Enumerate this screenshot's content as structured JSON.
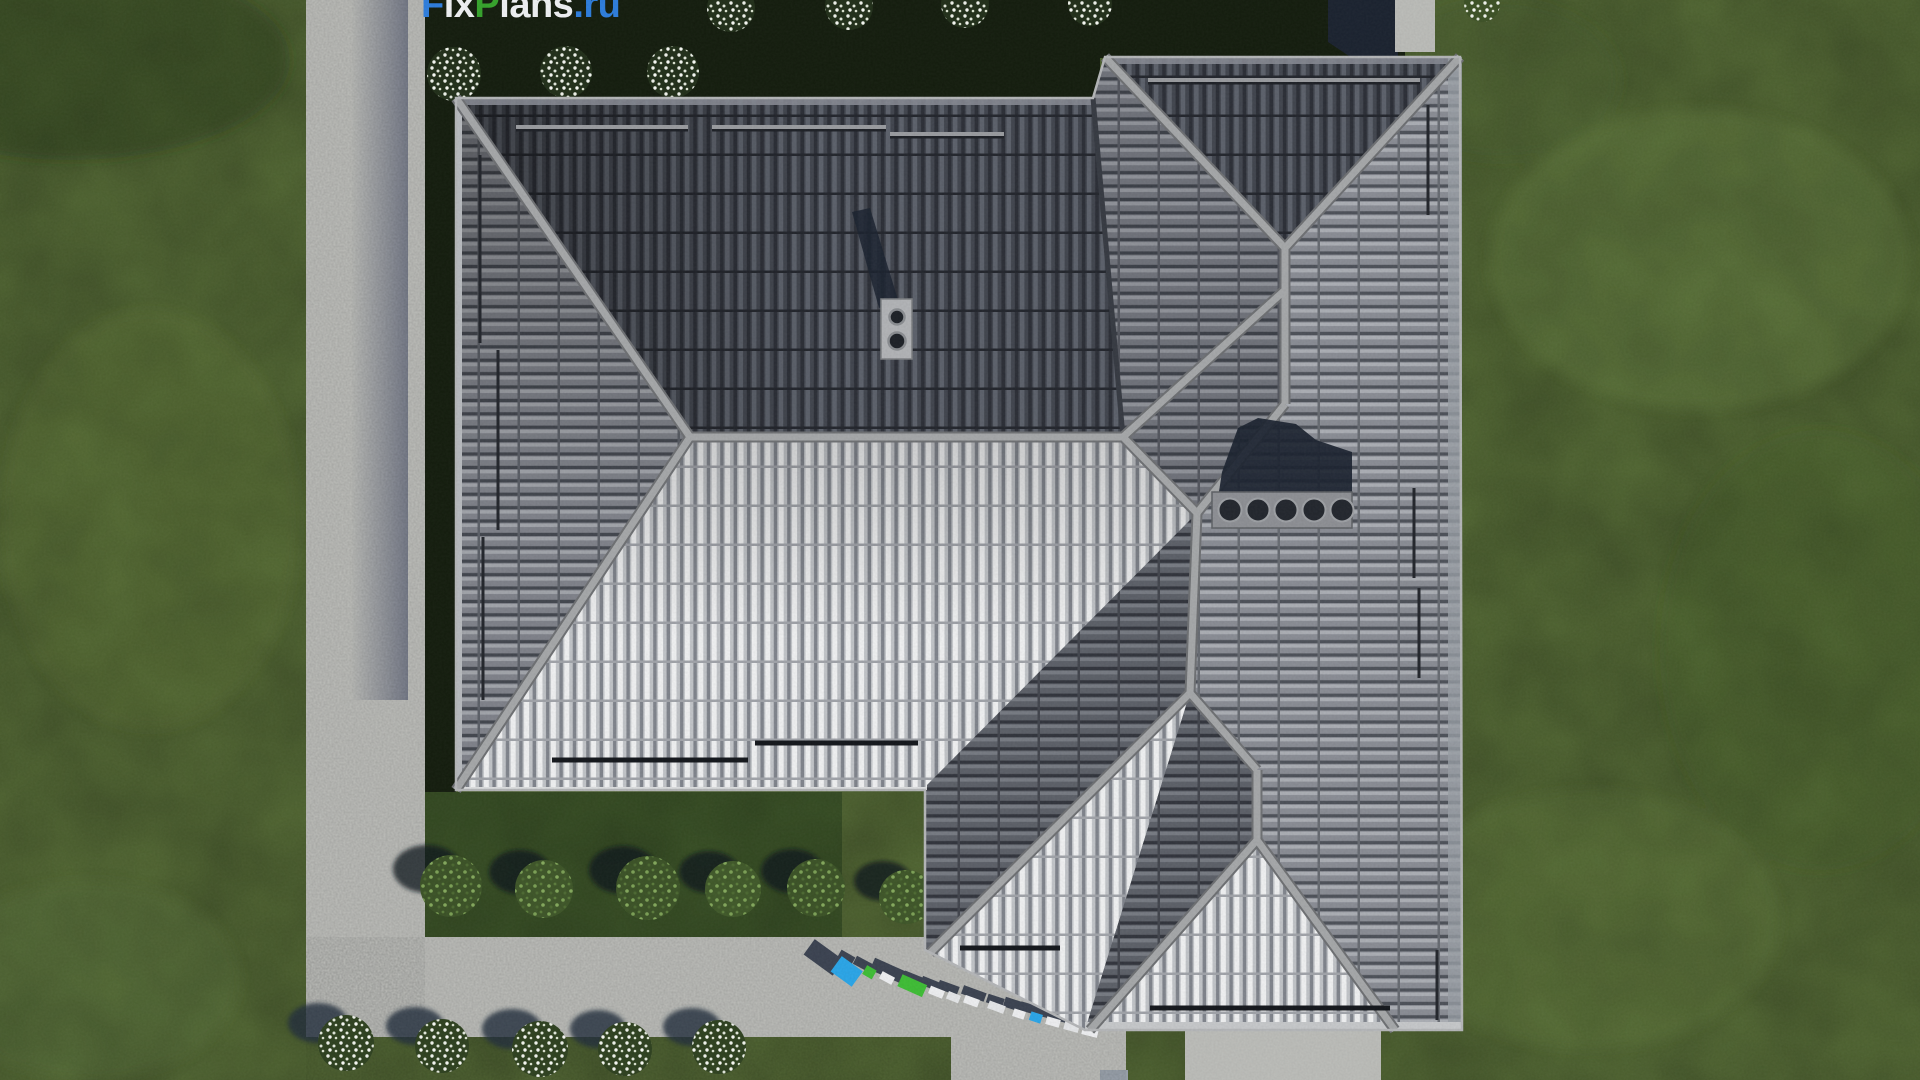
{
  "logo": {
    "parts": [
      {
        "text": "F",
        "color": "#2e7fe0"
      },
      {
        "text": "ix",
        "color": "#f2f4f6"
      },
      {
        "text": "P",
        "color": "#36a52c"
      },
      {
        "text": "lans",
        "color": "#f2f4f6"
      },
      {
        "text": ".ru",
        "color": "#2e7fe0"
      }
    ]
  },
  "palette": {
    "grassBase": "#556b35",
    "bedDark": "#141d0e",
    "shrubBed": "#3a5226",
    "concrete": "#bdbebA",
    "navyShadow": "#1b2330",
    "roofBase": "#5a5e66",
    "ridge": "#a7a9ab",
    "chimney": "#b3b5b8",
    "ventPlatform": "#8f9196",
    "letterBlue": "#2ba7ea",
    "letterGreen": "#3fbf36",
    "flowerWhite": "#eef2e9",
    "bushGreen": "#3c5327"
  },
  "objects": {
    "scene": "aerial-roof-render",
    "house": "hip-roof-house",
    "roofTop": "tiled-roof",
    "chimney": "chimney-two-flues",
    "vents": "roof-vent-row-5",
    "path": "concrete-garden-path",
    "shrubs": "green-shrub-row",
    "flowers": "white-flower-bushes",
    "letters": "3d-watermark-letters"
  }
}
